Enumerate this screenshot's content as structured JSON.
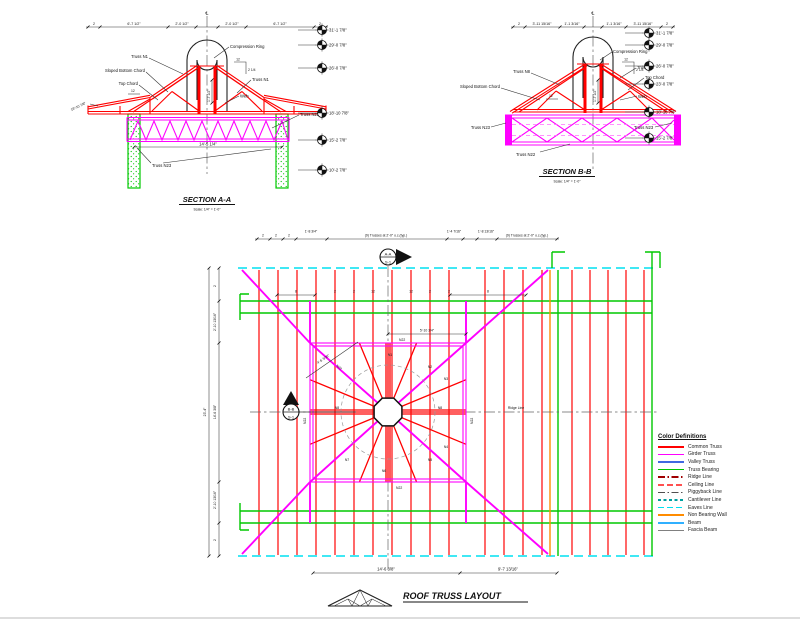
{
  "canvas": {
    "bg": "#ffffff",
    "centerline_symbol": "℄"
  },
  "section_a": {
    "title": "SECTION A-A",
    "scale": "Scale: 1/4\" = 1'-0\"",
    "labels": {
      "truss_left": "Truss N1",
      "sloped_bottom_chord": "Sloped Bottom Chord",
      "top_chord": "Top Chord",
      "compression_ring": "Compression Ring",
      "truss_right": "Truss N1",
      "web": "Web",
      "girder": "Truss N22",
      "bearing": "Truss N23"
    },
    "dims": {
      "top": [
        "2",
        "6'-7 1/2\"",
        "2'-0 1/2\"",
        "2'-0 1/2\"",
        "6'-7 1/2\"",
        "2"
      ],
      "girder_width": "14'-5 1/4\"",
      "ring_height": "1'-7 1/2\"",
      "slope_run": "12",
      "slope_rise": "2 1/4",
      "eave_elevation": "18'-10 7/8\""
    },
    "elevations": [
      "31'-1 7/8\"",
      "29'-0 7/8\"",
      "26'-0 7/8\"",
      "18'-10 7/8\"",
      "15'-2 7/8\"",
      "10'-2 7/8\""
    ]
  },
  "section_b": {
    "title": "SECTION B-B",
    "scale": "Scale: 1/4\" = 1'-0\"",
    "labels": {
      "truss_left": "Truss N8",
      "sloped_bottom_chord": "Sloped Bottom Chord",
      "bearing_left": "Truss N23",
      "compression_ring": "Compression Ring",
      "truss_right": "Truss N8",
      "top_chord": "Top Chord",
      "web": "Web",
      "bearing_right": "Truss N23",
      "girder": "Truss N22"
    },
    "dims": {
      "top": [
        "2",
        "3'-11 15/16\"",
        "1'-1 3/16\"",
        "1'-1 3/16\"",
        "3'-11 15/16\"",
        "2"
      ],
      "ring_height": "1'-7 1/2\"",
      "slope_run": "12",
      "slope_rise": "2 1/4"
    },
    "elevations": [
      "31'-1 7/8\"",
      "29'-0 7/8\"",
      "26'-0 7/8\"",
      "23'-0 7/8\"",
      "18'-10 7/8\"",
      "15'-2 7/8\""
    ]
  },
  "plan": {
    "title": "ROOF TRUSS LAYOUT",
    "ridge_label": "Ridge Line",
    "marker_a": {
      "label": "A-A",
      "sheet": "S-1"
    },
    "marker_b": {
      "label": "B-B",
      "sheet": "S-1"
    },
    "top_dims": [
      "2",
      "2",
      "2",
      "1'-8 3/4\"",
      "(9) Trusses at 2'-0\" o.c.(typ.)",
      "1'-4 7/16\"",
      "1'-8 13/16\"",
      "(9) Trusses at 2'-0\" o.c.(typ.)"
    ],
    "left_dims": {
      "overall": "23'-4\"",
      "segments": [
        "2",
        "2'-10 13/16\"",
        "14'-6 3/8\"",
        "2'-10 13/16\"",
        "2"
      ]
    },
    "bottom_dims": [
      "14'-6 3/8\"",
      "9'-7 13/16\""
    ],
    "girder_dim": "5'-10 3/4\"",
    "hip_dim": "4'-6 3/16\"",
    "truss_marks": [
      "8",
      "2",
      "2",
      "12",
      "12",
      "2",
      "2",
      "8"
    ],
    "radial_labels": [
      "N1",
      "N2",
      "N3",
      "N4",
      "N5",
      "N6",
      "N7",
      "N8"
    ],
    "girder_labels": {
      "top": "N22",
      "bottom": "N22",
      "left": "N22",
      "right": "N22",
      "hip": "N22"
    }
  },
  "legend": {
    "title": "Color Definitions",
    "items": [
      {
        "label": "Common Truss",
        "color": "#FF0000",
        "style": "solid"
      },
      {
        "label": "Girder Truss",
        "color": "#FF00FF",
        "style": "solid"
      },
      {
        "label": "Valley Truss",
        "color": "#4169E1",
        "style": "solid"
      },
      {
        "label": "Truss Bearing",
        "color": "#00C800",
        "style": "solid"
      },
      {
        "label": "Ridge Line",
        "color": "#A00000",
        "style": "dashdot"
      },
      {
        "label": "Ceiling Line",
        "color": "#FF5050",
        "style": "dashed"
      },
      {
        "label": "Piggyback Line",
        "color": "#505050",
        "style": "dashdot"
      },
      {
        "label": "Cantilever Line",
        "color": "#00A0A0",
        "style": "dashed-sm"
      },
      {
        "label": "Eaves Line",
        "color": "#00E0F0",
        "style": "dashed"
      },
      {
        "label": "Non Bearing Wall",
        "color": "#FF8C00",
        "style": "solid"
      },
      {
        "label": "Beam",
        "color": "#30B0FF",
        "style": "solid"
      },
      {
        "label": "Fascia Beam",
        "color": "#808080",
        "style": "solid"
      }
    ]
  }
}
